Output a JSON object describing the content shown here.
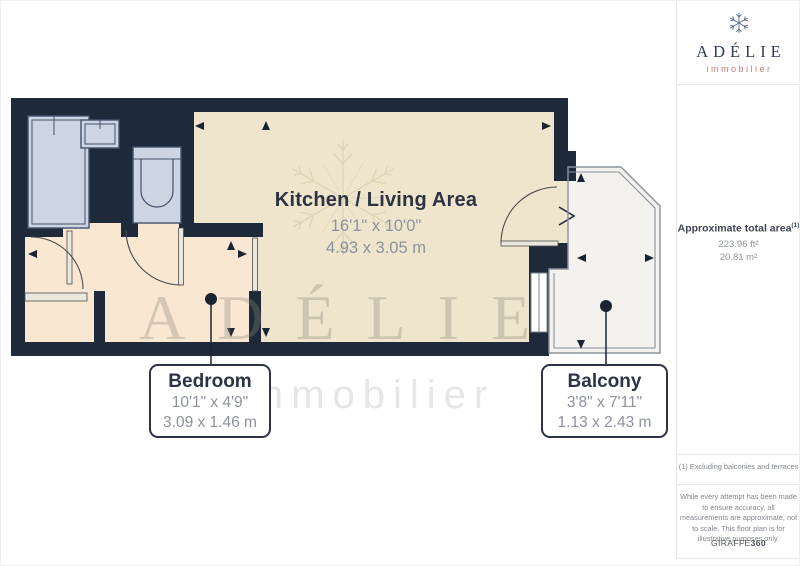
{
  "logo": {
    "brand": "ADÉLIE",
    "tagline": "immobilier"
  },
  "sidebar": {
    "area_title": "Approximate total area",
    "area_note_ref": "(1)",
    "area_imperial": "223.96 ft²",
    "area_metric": "20.81 m²",
    "footnote": "(1) Excluding balconies and terraces",
    "disclaimer": "While every attempt has been made to ensure accuracy, all measurements are approximate, not to scale. This floor plan is for illustrative purposes only.",
    "vendor_name": "GIRAFFE",
    "vendor_suffix": "360"
  },
  "rooms": {
    "kitchen": {
      "name": "Kitchen / Living Area",
      "imperial": "16'1\" x 10'0\"",
      "metric": "4.93 x 3.05 m"
    },
    "bedroom": {
      "name": "Bedroom",
      "imperial": "10'1\" x 4'9\"",
      "metric": "3.09 x 1.46 m"
    },
    "balcony": {
      "name": "Balcony",
      "imperial": "3'8\" x 7'11\"",
      "metric": "1.13 x 2.43 m"
    }
  },
  "watermark": {
    "brand": "ADÉLIE",
    "tagline": "immobilier"
  },
  "colors": {
    "wall": "#1e2a3a",
    "kitchen_floor": "#eee5cc",
    "bedroom_floor": "#f9e7d2",
    "fixture_fill": "#cdd5e3",
    "fixture_stroke": "#42526a",
    "balcony_fill": "#f3f2ef",
    "balcony_outline": "#8b929b",
    "navy_text": "#2b3345",
    "dim_text": "#8d929c",
    "brand_red": "#c88077"
  }
}
